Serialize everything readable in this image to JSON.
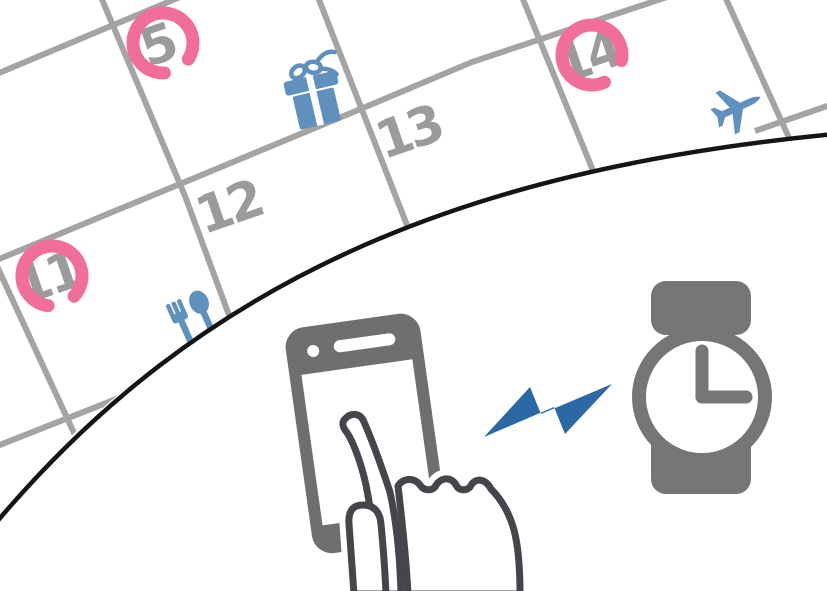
{
  "calendar": {
    "days": [
      {
        "label": "5",
        "circled": true
      },
      {
        "label": "12",
        "circled": false
      },
      {
        "label": "13",
        "circled": false
      },
      {
        "label": "14",
        "circled": true
      },
      {
        "label": "11",
        "circled": true
      }
    ],
    "event_icons": [
      "gift-icon",
      "airplane-icon",
      "utensils-icon"
    ]
  },
  "scene_icons": [
    "calendar-grid",
    "smartphone-icon",
    "touch-hand-icon",
    "lightning-bolt-icon",
    "smartwatch-icon"
  ],
  "colors": {
    "grid_line": "#a4a4a4",
    "day_number": "#9b9b9b",
    "highlight_ring": "#f06d9c",
    "event_icon_blue": "#6090bc",
    "bolt_blue": "#2c69a4",
    "phone_gray": "#6f6f6f",
    "watch_gray": "#767676",
    "hand_outline": "#45454b",
    "horizon_line": "#151515",
    "background": "#ffffff"
  }
}
